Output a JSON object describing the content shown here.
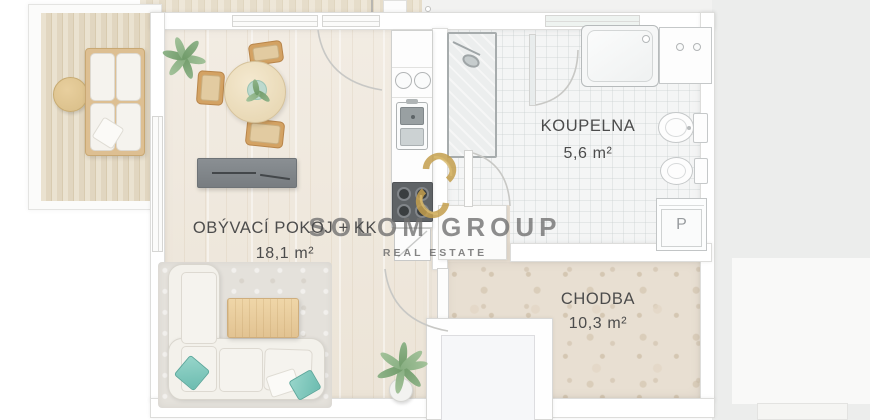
{
  "watermark": {
    "brand": "SOLOM GROUP",
    "tagline": "REAL ESTATE"
  },
  "rooms": {
    "living_room": {
      "name": "OBÝVACÍ POKOJ + KK",
      "area": "18,1 m²"
    },
    "bathroom": {
      "name": "KOUPELNA",
      "area": "5,6 m²"
    },
    "hallway": {
      "name": "CHODBA",
      "area": "10,3 m²"
    }
  },
  "appliances": {
    "washing_machine_label": "P"
  },
  "colors": {
    "brand_gold": "#c49f4d",
    "watermark_gray": "#707070",
    "accent_teal": "#8fd0c5",
    "hallway_floor": "#e8dfd2",
    "living_floor": "#efe8df"
  }
}
